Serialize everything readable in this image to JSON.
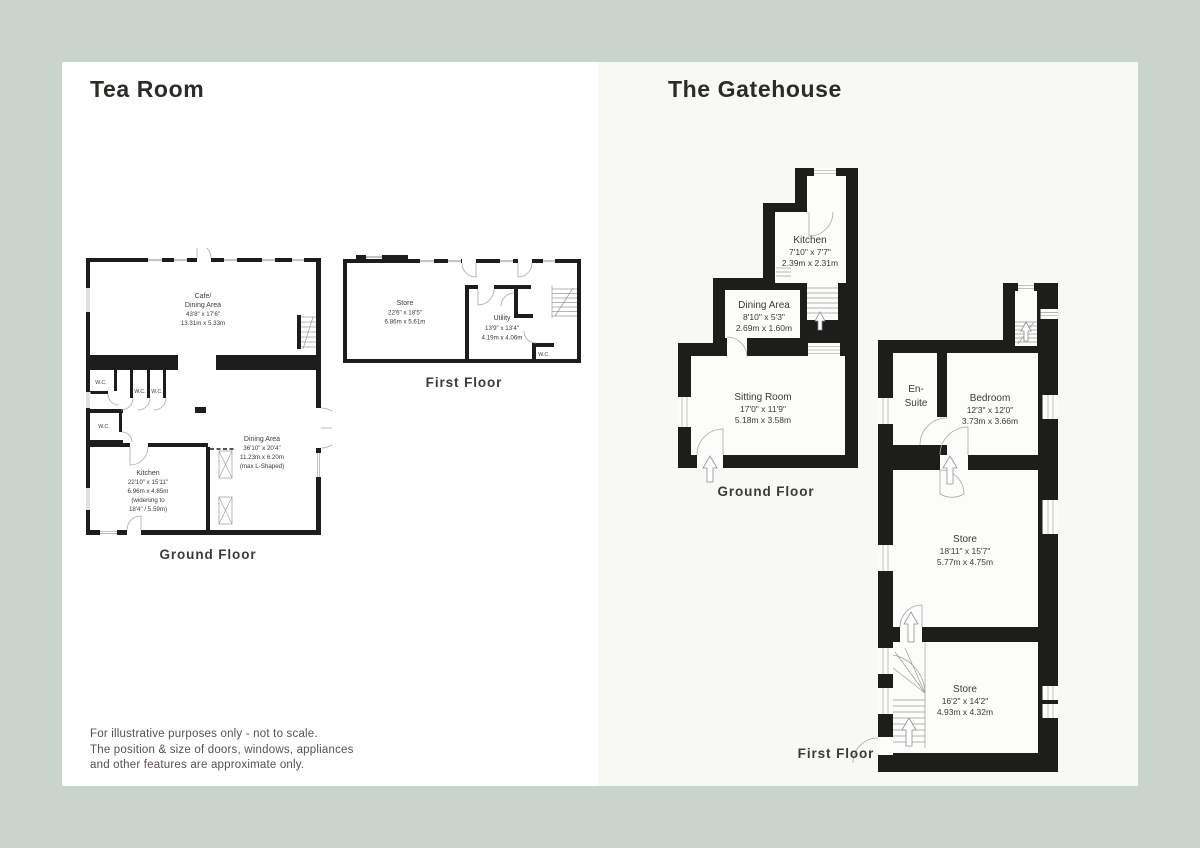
{
  "page": {
    "bg": "#c8d4cc",
    "left_panel_bg": "#ffffff",
    "right_panel_bg": "#f8f8f5",
    "wall_color": "#1d1d1b"
  },
  "tea_room": {
    "title": "Tea Room",
    "ground_floor_label": "Ground Floor",
    "first_floor_label": "First Floor",
    "rooms": {
      "cafe": {
        "name1": "Cafe/",
        "name2": "Dining Area",
        "imperial": "43'8\" x 17'6\"",
        "metric": "13.31m x 5.33m"
      },
      "kitchen": {
        "name": "Kitchen",
        "imperial": "22'10\" x 15'11\"",
        "metric": "6.96m x 4.85m",
        "note1": "(widening to",
        "note2": "18'4\" / 5.59m)"
      },
      "dining": {
        "name": "Dining Area",
        "imperial": "36'10\" x 20'4\"",
        "metric": "11.23m x 6.20m",
        "note": "(max L-Shaped)"
      },
      "wc": "W.C.",
      "store": {
        "name": "Store",
        "imperial": "22'6\" x 18'5\"",
        "metric": "6.86m x 5.61m"
      },
      "utility": {
        "name": "Utility",
        "imperial": "13'9\" x 13'4\"",
        "metric": "4.19m x 4.06m"
      }
    }
  },
  "gatehouse": {
    "title": "The Gatehouse",
    "ground_floor_label": "Ground Floor",
    "first_floor_label": "First Floor",
    "rooms": {
      "kitchen": {
        "name": "Kitchen",
        "imperial": "7'10\" x 7'7\"",
        "metric": "2.39m x 2.31m"
      },
      "dining": {
        "name": "Dining Area",
        "imperial": "8'10\" x 5'3\"",
        "metric": "2.69m x 1.60m"
      },
      "sitting": {
        "name": "Sitting Room",
        "imperial": "17'0\" x 11'9\"",
        "metric": "5.18m x 3.58m"
      },
      "ensuite": {
        "name1": "En-",
        "name2": "Suite"
      },
      "bedroom": {
        "name": "Bedroom",
        "imperial": "12'3\" x 12'0\"",
        "metric": "3.73m x 3.66m"
      },
      "store_mid": {
        "name": "Store",
        "imperial": "18'11\" x 15'7\"",
        "metric": "5.77m x 4.75m"
      },
      "store_low": {
        "name": "Store",
        "imperial": "16'2\" x 14'2\"",
        "metric": "4.93m x 4.32m"
      }
    }
  },
  "disclaimer": {
    "line1": "For illustrative purposes only - not to scale.",
    "line2": "The position & size of doors, windows, appliances",
    "line3": "and other features are approximate only."
  }
}
